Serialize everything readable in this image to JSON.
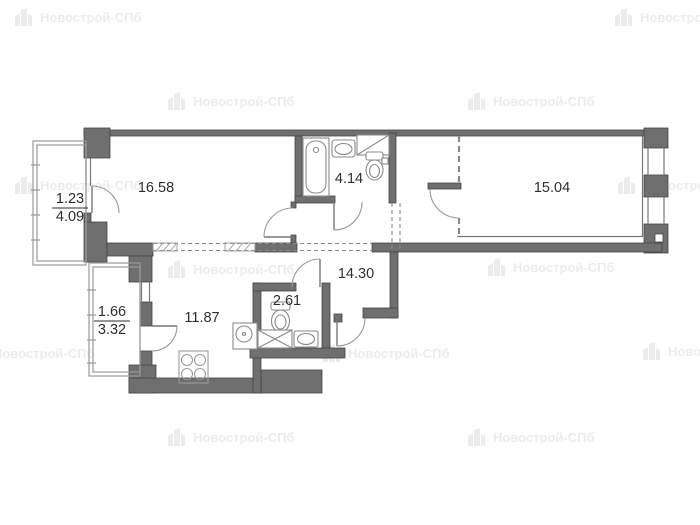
{
  "watermark": {
    "text": "Новострой-СПб"
  },
  "rooms": {
    "living": {
      "area": "16.58"
    },
    "bathroom": {
      "area": "4.14"
    },
    "bedroom": {
      "area": "15.04"
    },
    "hallway": {
      "area": "14.30"
    },
    "wc": {
      "area": "2.61"
    },
    "kitchen": {
      "area": "11.87"
    },
    "balcony_top": {
      "reduced_area": "1.23",
      "full_area": "4.09"
    },
    "balcony_bottom": {
      "reduced_area": "1.66",
      "full_area": "3.32"
    }
  },
  "colors": {
    "wall": "#6f6f6f",
    "wall_outline": "#454545",
    "thin_line": "#8f8f8f",
    "label": "#2e2e2e",
    "watermark": "#ececec"
  }
}
